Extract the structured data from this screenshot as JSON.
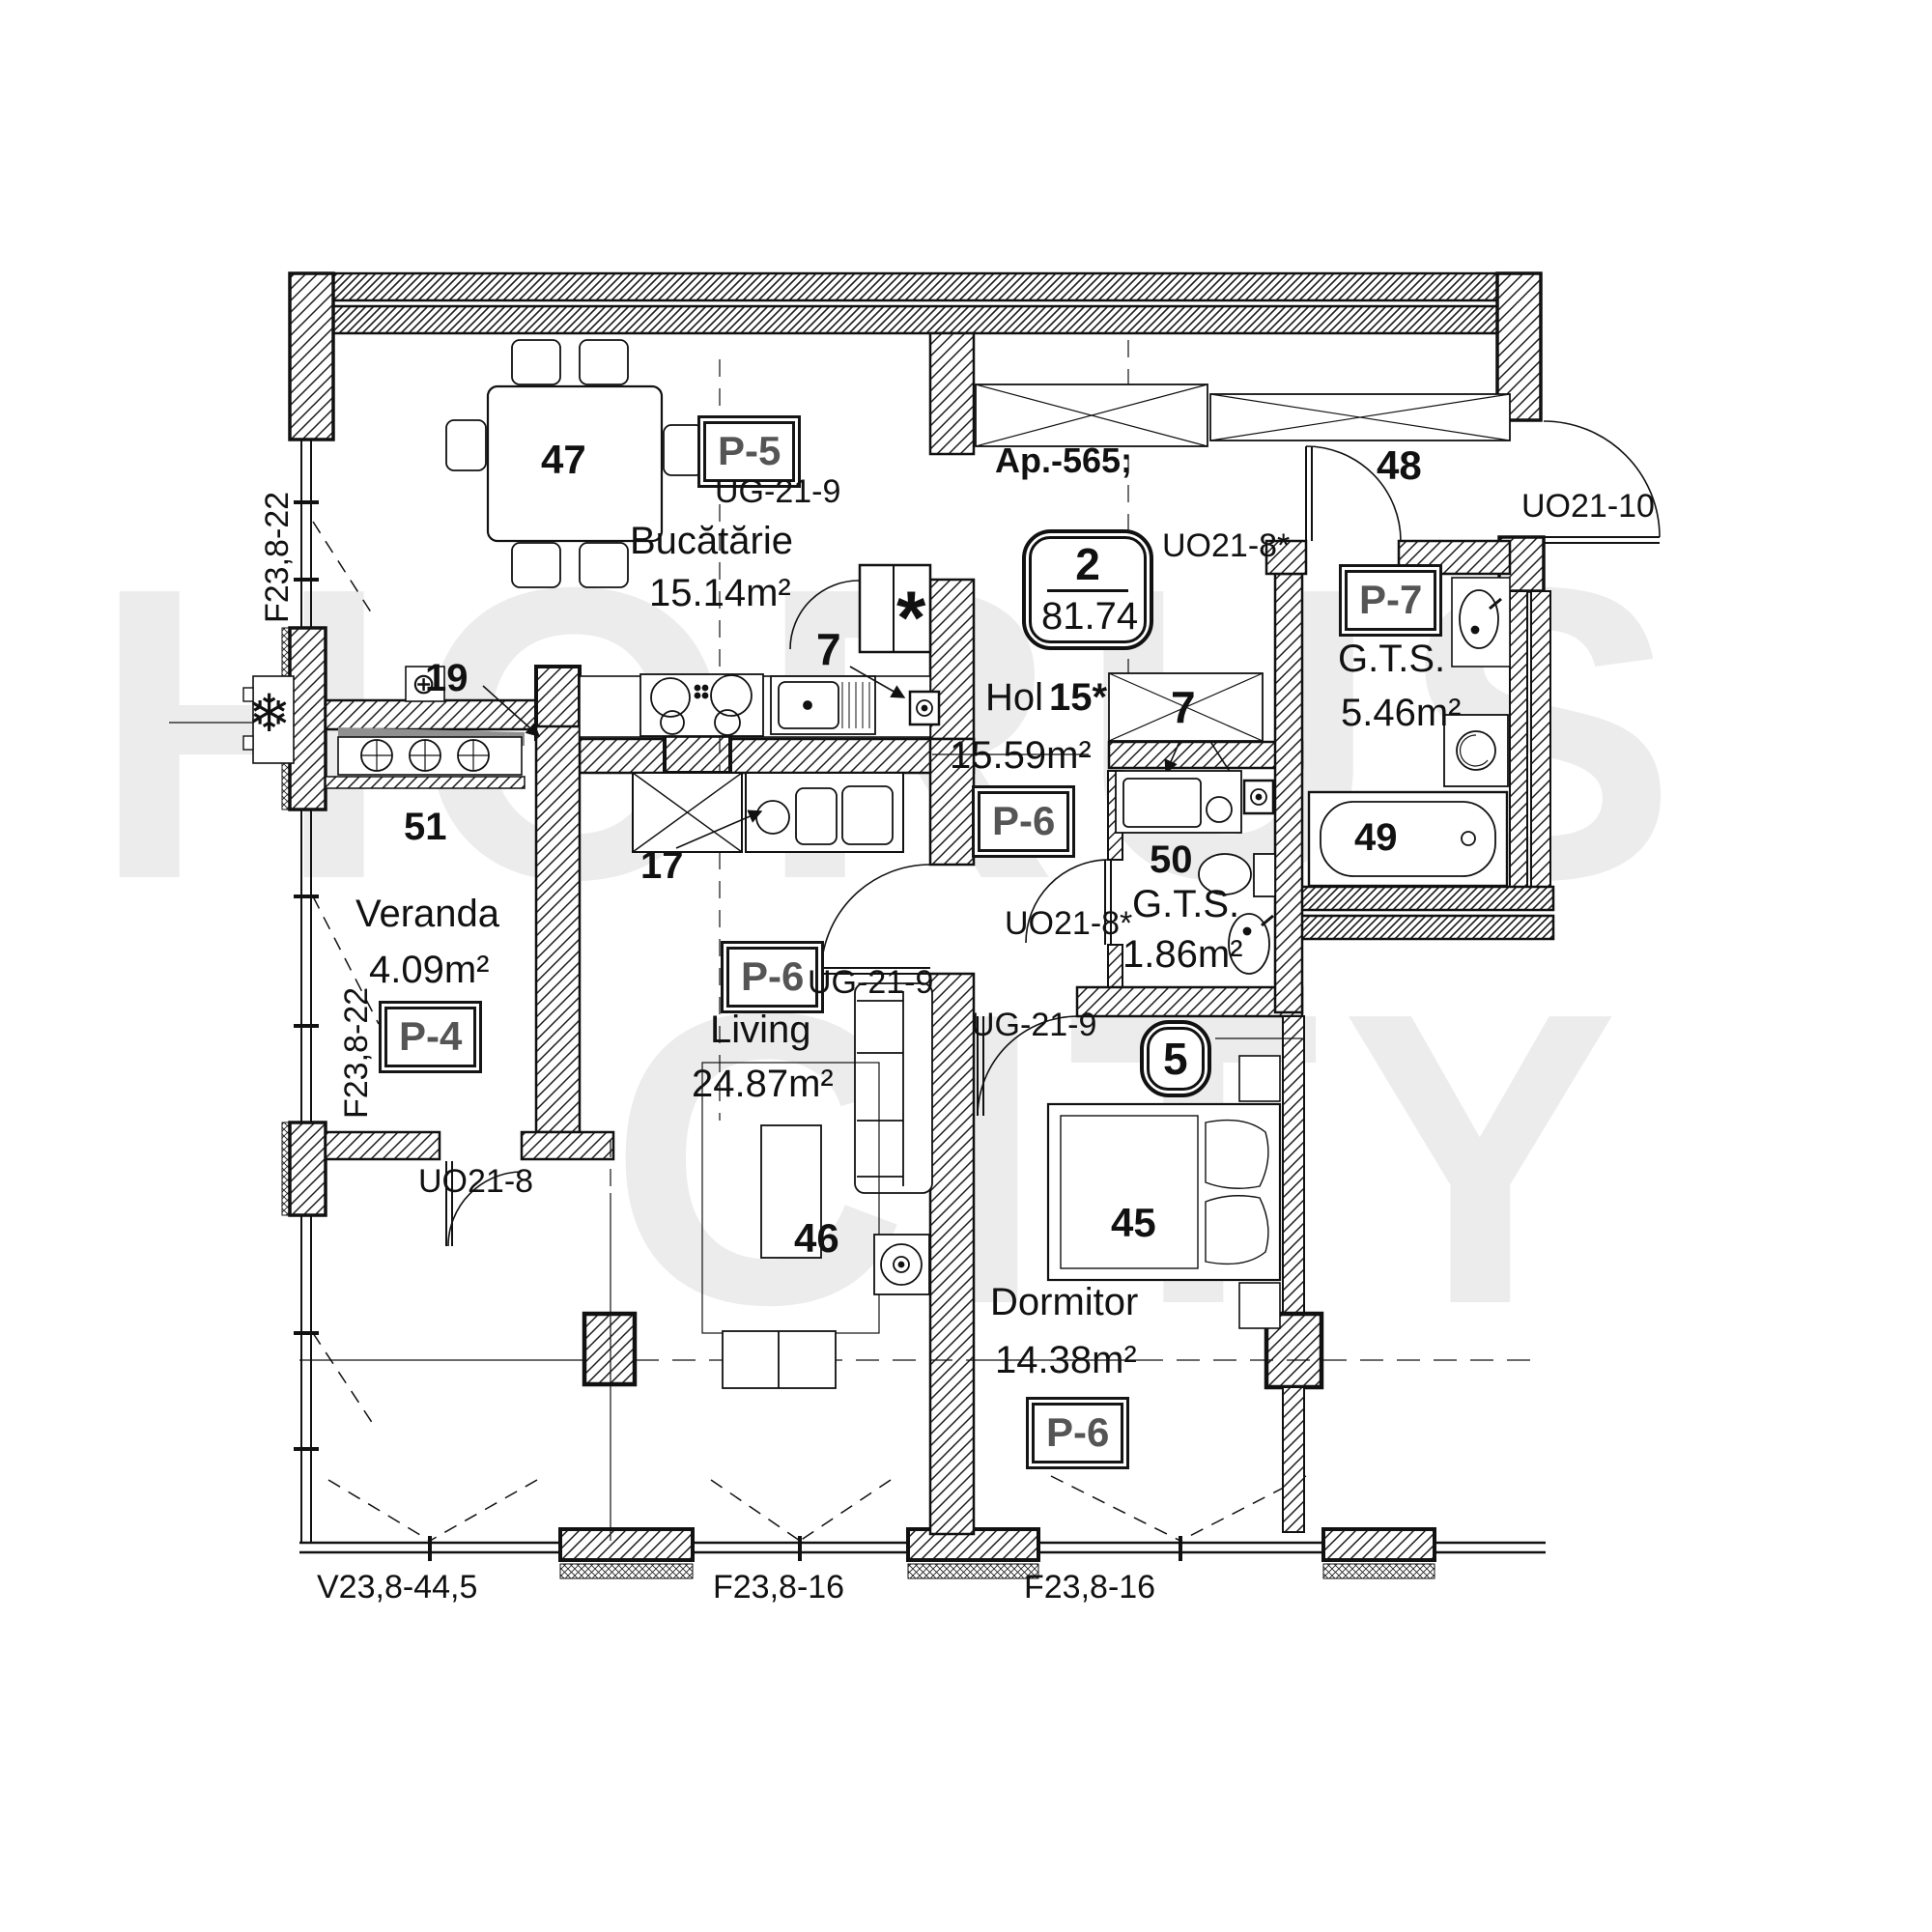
{
  "watermark": {
    "line1": "HORUS",
    "line2": "CITY"
  },
  "apartment": {
    "label": "Ap.-565;",
    "badge_rooms": "2",
    "badge_area": "81.74"
  },
  "rooms": {
    "bucatarie": {
      "name": "Bucătărie",
      "area": "15.14m²",
      "furniture_number": "47",
      "panel": "P-5",
      "vent_number": "7"
    },
    "hol": {
      "name": "Hol",
      "index": "15*",
      "area": "15.59m²",
      "panel": "P-6",
      "wardrobe_number": "7"
    },
    "entry": {
      "number": "48"
    },
    "gts_mare": {
      "name": "G.T.S.",
      "area": "5.46m²",
      "panel": "P-7",
      "tub_number": "49"
    },
    "gts_mic": {
      "name": "G.T.S.",
      "area": "1.86m²",
      "number": "50"
    },
    "veranda": {
      "name": "Veranda",
      "area": "4.09m²",
      "number": "51",
      "panel": "P-4",
      "radiator_number": "19"
    },
    "living": {
      "name": "Living",
      "area": "24.87m²",
      "panel": "P-6",
      "table_number": "46",
      "kitchen_unit_number": "17"
    },
    "dormitor": {
      "name": "Dormitor",
      "area": "14.38m²",
      "panel": "P-6",
      "bed_number": "45",
      "window_badge": "5"
    }
  },
  "doors": {
    "kitchen": "UG-21-9",
    "living": "UG-21-9",
    "dormitor": "UG-21-9",
    "veranda": "UO21-8",
    "gts_mare": "UO21-8*",
    "gts_mic": "UO21-8*",
    "entrance": "UO21-10"
  },
  "windows": {
    "left_kitchen": "F23,8-22",
    "left_veranda": "F23,8-22",
    "bottom_living_west": "V23,8-44,5",
    "bottom_living": "F23,8-16",
    "bottom_dormitor": "F23,8-16"
  },
  "icons": {
    "snowflake": "❄",
    "circled_plus": "⊕",
    "asterisk": "*"
  }
}
